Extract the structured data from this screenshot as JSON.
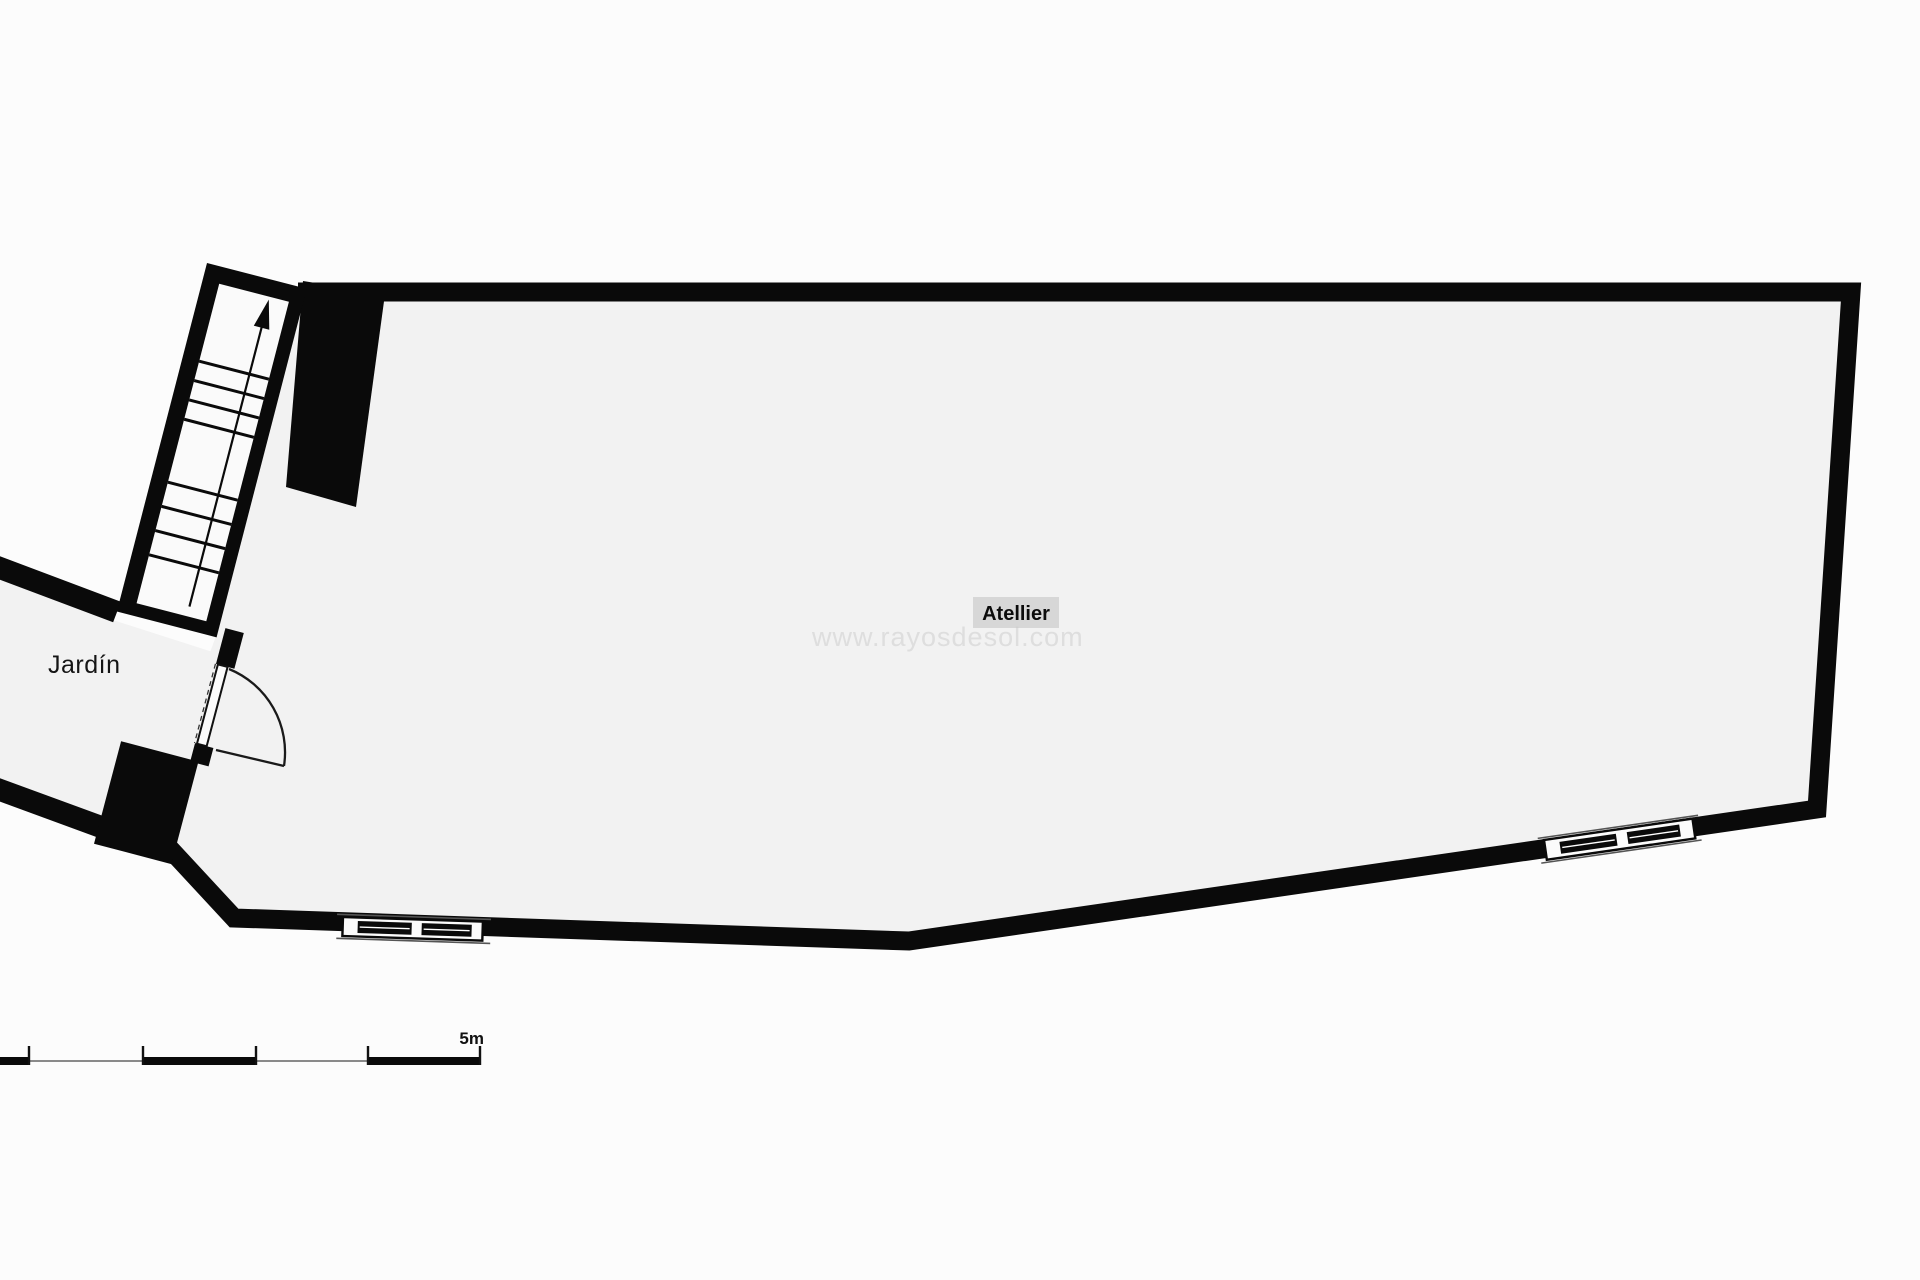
{
  "plan": {
    "room_label": "Atellier",
    "garden_label": "Jardín",
    "watermark": "www.rayosdesol.com",
    "scale_label": "5m",
    "colors": {
      "wall": "#0a0a0a",
      "floor": "#f2f2f2",
      "stair_interior": "#fafafa",
      "room_label_bg": "#d7d7d7",
      "watermark": "#c9c9c9",
      "scale_thin_line": "#8a8a8a",
      "background": "#fcfcfc"
    }
  }
}
